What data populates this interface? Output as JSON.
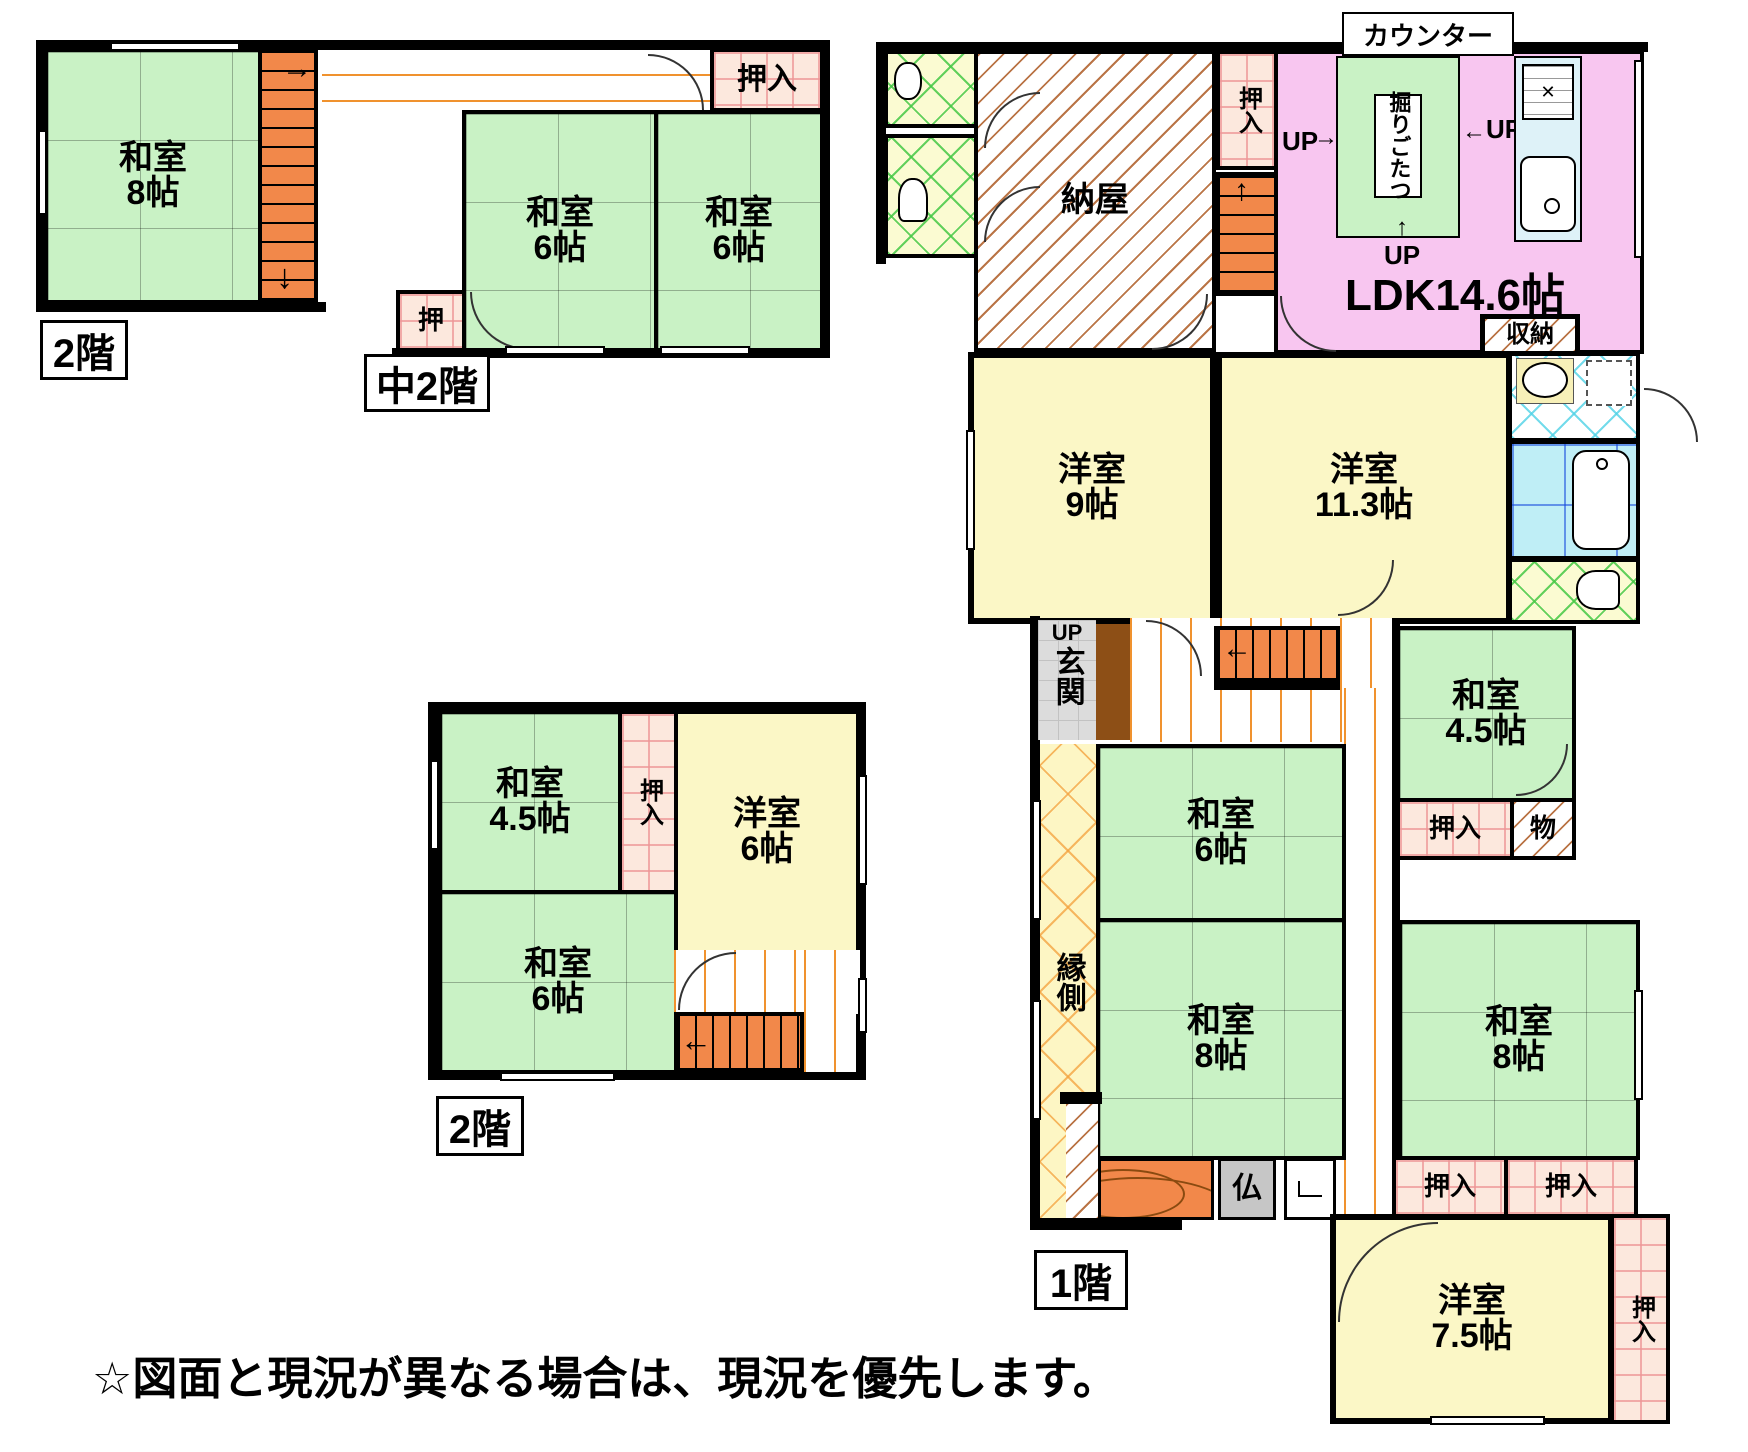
{
  "titles": {
    "floor2_top": "2階",
    "mid2": "中2階",
    "floor2_bottom": "2階",
    "floor1": "1階"
  },
  "note": "☆図面と現況が異なる場合は、現況を優先します。",
  "up": "UP",
  "arrows": {
    "right": "→",
    "left": "←",
    "up": "↑",
    "down": "↓"
  },
  "rooms": {
    "f2_washitsu8": {
      "name": "和室",
      "size": "8帖"
    },
    "m2_washitsu6_left": {
      "name": "和室",
      "size": "6帖"
    },
    "m2_washitsu6_right": {
      "name": "和室",
      "size": "6帖"
    },
    "m2_oshiire": "押入",
    "m2_oshi": "押",
    "f2b_washitsu45": {
      "name": "和室",
      "size": "4.5帖"
    },
    "f2b_oshiire": "押入",
    "f2b_youshitsu6": {
      "name": "洋室",
      "size": "6帖"
    },
    "f2b_washitsu6": {
      "name": "和室",
      "size": "6帖"
    },
    "f1_naya": "納屋",
    "f1_oshiire_stairs": "押入",
    "f1_counter": "カウンター",
    "f1_horigotatsu": "掘りごたつ",
    "f1_ldk": "LDK14.6帖",
    "f1_shuunou": "収納",
    "f1_youshitsu9": {
      "name": "洋室",
      "size": "9帖"
    },
    "f1_youshitsu113": {
      "name": "洋室",
      "size": "11.3帖"
    },
    "f1_washitsu45": {
      "name": "和室",
      "size": "4.5帖"
    },
    "f1_oshiire_45": "押入",
    "f1_mono": "物",
    "f1_genkan": "玄関",
    "f1_engawa": "縁側",
    "f1_washitsu6": {
      "name": "和室",
      "size": "6帖"
    },
    "f1_washitsu8_center": {
      "name": "和室",
      "size": "8帖"
    },
    "f1_washitsu8_right": {
      "name": "和室",
      "size": "8帖"
    },
    "f1_butsudan": "仏",
    "f1_oshiire_center_left": "押入",
    "f1_oshiire_center_right": "押入",
    "f1_youshitsu75": {
      "name": "洋室",
      "size": "7.5帖"
    },
    "f1_oshiire_75": "押入"
  }
}
